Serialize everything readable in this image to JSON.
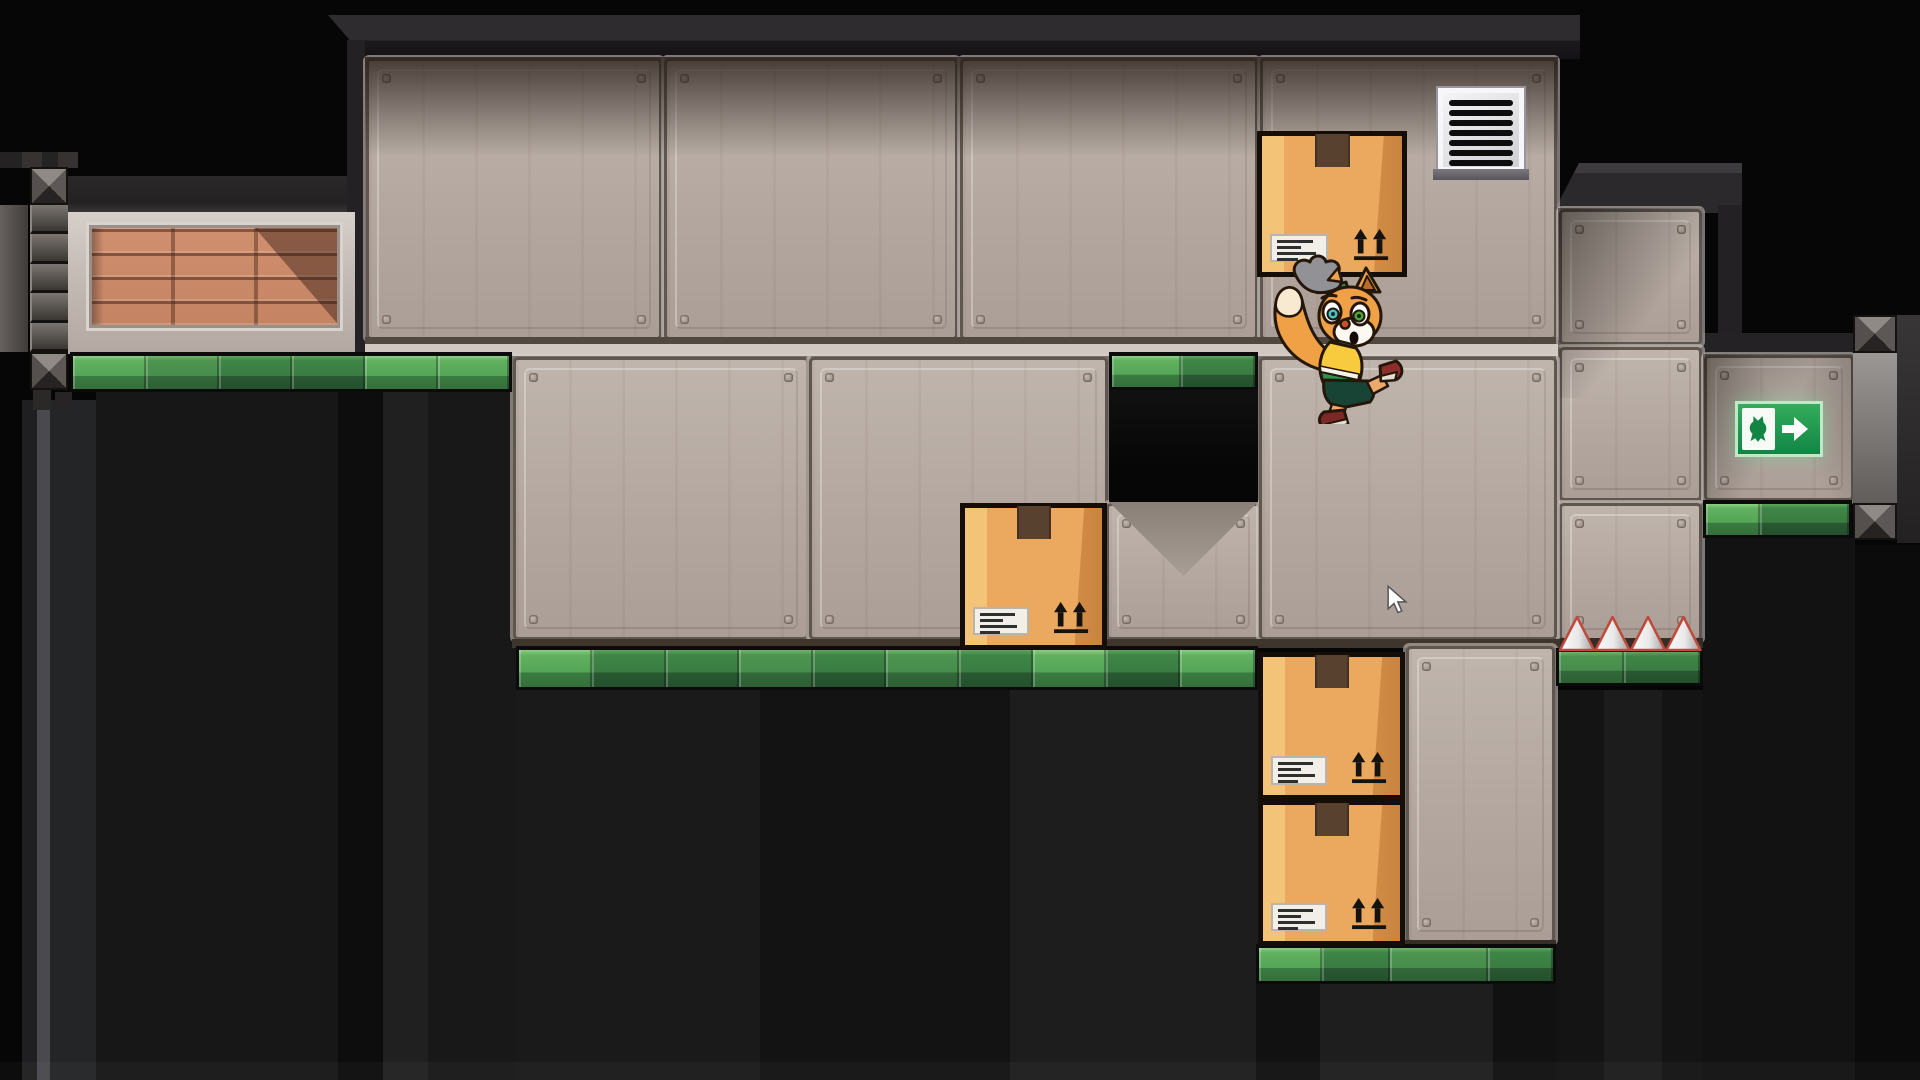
{
  "meta": {
    "app": "2d-puzzle-platformer-level",
    "viewport": {
      "width": 1920,
      "height": 1080
    },
    "scene_summary": "Warehouse-style platformer level: fox character jumps and bumps a cardboard box, three more boxes block passages, green-edged platforms, wall vent, exit sign with fox silhouette and arrow, four floor spikes, riveted metal girders, brick inset wall, dark pits below."
  },
  "palette": {
    "background": "#060606",
    "panel_base": "#b3a79f",
    "panel_groove_dark": "#5f564e",
    "panel_groove_light": "#d7cfc9",
    "green_light": "#61b160",
    "green_mid": "#4c9550",
    "green_dark": "#3f8547",
    "box_face": "#eaa95e",
    "box_shade": "#d18c44",
    "box_highlight": "#f3c377",
    "box_outline": "#150e08",
    "exit_green": "#128544",
    "spike_outline": "#bf4a3c",
    "character_fur": "#f0a145",
    "character_sleeve": "#2f9464",
    "character_vest": "#f8ca3e",
    "character_shorts": "#174434",
    "character_shoe": "#8e2e2c",
    "eye_left_iris": "#49c2c6",
    "eye_right_iris": "#4da53e"
  },
  "entities": {
    "boxes_count": 4,
    "spikes_count": 4,
    "vent_slats": 7,
    "box_marking": "this-side-up arrows + shipping label",
    "exit_sign_glyphs": [
      "fox-silhouette",
      "right-arrow"
    ]
  },
  "items": [
    {
      "kind": "rect",
      "name": "pit-stripe",
      "x": 22,
      "y": 400,
      "w": 15,
      "h": 680,
      "bg": "#1f1f21"
    },
    {
      "kind": "rect",
      "name": "pit-stripe",
      "x": 37,
      "y": 400,
      "w": 13,
      "h": 680,
      "bg": "#4a4a4e"
    },
    {
      "kind": "rect",
      "name": "pit-stripe",
      "x": 50,
      "y": 400,
      "w": 46,
      "h": 680,
      "bg": "#232527"
    },
    {
      "kind": "rect",
      "name": "pit-stripe",
      "x": 96,
      "y": 392,
      "w": 242,
      "h": 688,
      "bg": "#171717"
    },
    {
      "kind": "rect",
      "name": "pit-stripe",
      "x": 338,
      "y": 392,
      "w": 45,
      "h": 688,
      "bg": "#0d0d0d"
    },
    {
      "kind": "rect",
      "name": "pit-stripe",
      "x": 383,
      "y": 392,
      "w": 45,
      "h": 688,
      "bg": "#202020"
    },
    {
      "kind": "rect",
      "name": "pit-stripe",
      "x": 428,
      "y": 392,
      "w": 88,
      "h": 688,
      "bg": "#181818"
    },
    {
      "kind": "rect",
      "name": "pit-stripe",
      "x": 516,
      "y": 690,
      "w": 244,
      "h": 390,
      "bg": "#1a1a1a"
    },
    {
      "kind": "rect",
      "name": "pit-stripe",
      "x": 760,
      "y": 690,
      "w": 250,
      "h": 390,
      "bg": "#131313"
    },
    {
      "kind": "rect",
      "name": "pit-stripe",
      "x": 1010,
      "y": 690,
      "w": 248,
      "h": 390,
      "bg": "#1d1d1d"
    },
    {
      "kind": "rect",
      "name": "pit-stripe",
      "x": 1256,
      "y": 984,
      "w": 64,
      "h": 96,
      "bg": "#111111"
    },
    {
      "kind": "rect",
      "name": "pit-stripe",
      "x": 1320,
      "y": 984,
      "w": 173,
      "h": 96,
      "bg": "#1e1e1e"
    },
    {
      "kind": "rect",
      "name": "pit-stripe",
      "x": 1493,
      "y": 984,
      "w": 63,
      "h": 96,
      "bg": "#111111"
    },
    {
      "kind": "rect",
      "name": "pit-stripe",
      "x": 1556,
      "y": 690,
      "w": 147,
      "h": 390,
      "bg": "#141414"
    },
    {
      "kind": "rect",
      "name": "pit-stripe",
      "x": 1604,
      "y": 690,
      "w": 58,
      "h": 390,
      "bg": "#1c1c1c"
    },
    {
      "kind": "rect",
      "name": "pit-stripe",
      "x": 1703,
      "y": 538,
      "w": 152,
      "h": 542,
      "bg": "#121212"
    },
    {
      "kind": "rect",
      "name": "pit-stripe",
      "x": 1855,
      "y": 545,
      "w": 65,
      "h": 535,
      "bg": "#0b0b0b"
    },
    {
      "kind": "rect",
      "name": "floor-sheen",
      "x": 0,
      "y": 1062,
      "w": 1920,
      "h": 18,
      "bg": "rgba(255,255,255,0.03)"
    },
    {
      "kind": "rect",
      "name": "ceiling-band",
      "x": 328,
      "y": 15,
      "w": 1252,
      "h": 44,
      "bg": "linear-gradient(180deg,#2e2c2f 0%,#2e2c2f 58%,#1b191c 58%,#141216 100%)",
      "clip": "polygon(0px 0px,100% 0px,100% 100%,38px 100%)"
    },
    {
      "kind": "rect",
      "name": "room-left-wall-edge",
      "x": 347,
      "y": 40,
      "w": 18,
      "h": 316,
      "bg": "#232123"
    },
    {
      "kind": "rect",
      "name": "ceiling-band",
      "x": 68,
      "y": 176,
      "w": 279,
      "h": 38,
      "bg": "linear-gradient(180deg,#2a2829 0%,#232122 70%,#3c3a39 100%)"
    },
    {
      "kind": "rect",
      "name": "ceiling-step-cap",
      "x": 1553,
      "y": 163,
      "w": 189,
      "h": 50,
      "bg": "linear-gradient(180deg,#3d3b3e 0%,#3d3b3e 20%,#2b292c 20%)",
      "clip": "polygon(26px 0,100% 0,100% 100%,0 100%)"
    },
    {
      "kind": "rect",
      "name": "ceiling-step-side",
      "x": 1718,
      "y": 205,
      "w": 24,
      "h": 130,
      "bg": "#232123"
    },
    {
      "kind": "rect",
      "name": "alcove-ceiling",
      "x": 1703,
      "y": 333,
      "w": 152,
      "h": 23,
      "bg": "#242224"
    },
    {
      "kind": "panel",
      "name": "wall-panel",
      "x": 369,
      "y": 61,
      "w": 290,
      "h": 276
    },
    {
      "kind": "panel",
      "name": "wall-panel",
      "x": 667,
      "y": 61,
      "w": 288,
      "h": 276
    },
    {
      "kind": "panel",
      "name": "wall-panel",
      "x": 963,
      "y": 61,
      "w": 292,
      "h": 276
    },
    {
      "kind": "panel",
      "name": "wall-panel",
      "x": 1263,
      "y": 61,
      "w": 291,
      "h": 276
    },
    {
      "kind": "rect",
      "name": "floor-seam",
      "x": 365,
      "y": 337,
      "w": 1193,
      "h": 7,
      "bg": "#51483f"
    },
    {
      "kind": "rect",
      "name": "floor-seam",
      "x": 365,
      "y": 344,
      "w": 1193,
      "h": 12,
      "bg": "#d1c8c2"
    },
    {
      "kind": "rect",
      "name": "ceiling-shadow",
      "x": 365,
      "y": 57,
      "w": 1193,
      "h": 100,
      "bg": "linear-gradient(180deg,rgba(38,28,22,0.80),rgba(38,28,22,0))"
    },
    {
      "kind": "panel",
      "name": "wall-panel",
      "x": 1562,
      "y": 212,
      "w": 137,
      "h": 130
    },
    {
      "kind": "panel",
      "name": "wall-panel",
      "x": 1562,
      "y": 350,
      "w": 137,
      "h": 148
    },
    {
      "kind": "panel",
      "name": "wall-panel",
      "x": 1562,
      "y": 506,
      "w": 137,
      "h": 132
    },
    {
      "kind": "rect",
      "name": "wall-bottom-edge",
      "x": 1558,
      "y": 638,
      "w": 145,
      "h": 12,
      "bg": "#352e27"
    },
    {
      "kind": "rect",
      "name": "step-shadow",
      "x": 1558,
      "y": 208,
      "w": 145,
      "h": 190,
      "bg": "linear-gradient(128deg,rgba(15,10,7,0.55),rgba(15,10,7,0) 60%)"
    },
    {
      "kind": "panel",
      "name": "wall-panel",
      "x": 516,
      "y": 360,
      "w": 290,
      "h": 277
    },
    {
      "kind": "panel",
      "name": "wall-panel",
      "x": 812,
      "y": 360,
      "w": 293,
      "h": 277
    },
    {
      "kind": "panel",
      "name": "wall-panel",
      "x": 1109,
      "y": 506,
      "w": 149,
      "h": 131
    },
    {
      "kind": "panel",
      "name": "wall-panel",
      "x": 1262,
      "y": 360,
      "w": 292,
      "h": 277
    },
    {
      "kind": "rect",
      "name": "wall-bottom-edge",
      "x": 512,
      "y": 639,
      "w": 1048,
      "h": 9,
      "bg": "#3e352c"
    },
    {
      "kind": "tri",
      "name": "alcove-shadow-triangle",
      "x": 1109,
      "y": 502,
      "w": 149,
      "h": 74,
      "bg": "linear-gradient(180deg,#8a7f76,#a99e96)",
      "clip": "polygon(0 0,100% 0,50% 100%)"
    },
    {
      "kind": "rect",
      "name": "recessed-alcove",
      "x": 1109,
      "y": 388,
      "w": 149,
      "h": 114,
      "bg": "linear-gradient(180deg,#111111,#060606 70%)"
    },
    {
      "kind": "panel",
      "name": "wall-panel",
      "x": 1409,
      "y": 649,
      "w": 143,
      "h": 291
    },
    {
      "kind": "rect",
      "name": "wall-bottom-edge",
      "x": 1405,
      "y": 940,
      "w": 151,
      "h": 8,
      "bg": "#352d26"
    },
    {
      "kind": "panel",
      "name": "wall-panel",
      "x": 1707,
      "y": 358,
      "w": 144,
      "h": 140
    },
    {
      "kind": "rect",
      "name": "exit-alcove-shadow",
      "x": 1703,
      "y": 354,
      "w": 152,
      "h": 148,
      "bg": "linear-gradient(118deg,rgba(18,12,8,0.50),rgba(18,12,8,0) 50%)"
    },
    {
      "kind": "rect",
      "name": "exit-alcove-shadow",
      "x": 1703,
      "y": 354,
      "w": 152,
      "h": 148,
      "bg": "linear-gradient(242deg,rgba(18,12,8,0.30),rgba(18,12,8,0) 45%)"
    },
    {
      "kind": "rect",
      "name": "brick-frame",
      "x": 68,
      "y": 212,
      "w": 287,
      "h": 142,
      "bg": "linear-gradient(180deg,#d6cfca 0%,#c6bdb7 40%,#b3a8a1 100%)"
    },
    {
      "kind": "bricks",
      "name": "brick-inset",
      "x": 92,
      "y": 228,
      "w": 245,
      "h": 97
    },
    {
      "kind": "tri",
      "name": "brick-shadow",
      "x": 255,
      "y": 228,
      "w": 82,
      "h": 95,
      "bg": "rgba(40,20,12,0.42)",
      "clip": "polygon(0 0,100% 0,100% 100%)"
    },
    {
      "kind": "rect",
      "name": "brick-shadow",
      "x": 92,
      "y": 228,
      "w": 12,
      "h": 97,
      "bg": "linear-gradient(90deg,rgba(0,0,0,0.30),rgba(0,0,0,0))"
    },
    {
      "kind": "rect",
      "name": "girder-top-band",
      "x": 0,
      "y": 152,
      "w": 78,
      "h": 16,
      "bg": "#242222"
    },
    {
      "kind": "rect",
      "name": "girder-top-band",
      "x": 22,
      "y": 152,
      "w": 20,
      "h": 16,
      "bg": "#353231"
    },
    {
      "kind": "rect",
      "name": "girder-top-band",
      "x": 58,
      "y": 152,
      "w": 20,
      "h": 16,
      "bg": "#353231"
    },
    {
      "kind": "xtile",
      "name": "girder-cross-joint",
      "x": 30,
      "y": 167,
      "w": 38,
      "h": 38
    },
    {
      "kind": "rect",
      "name": "girder-bar",
      "x": 0,
      "y": 205,
      "w": 28,
      "h": 147,
      "bg": "linear-gradient(90deg,#66615e,#403c3a)"
    },
    {
      "kind": "segcol",
      "name": "girder-segments",
      "x": 30,
      "y": 205,
      "w": 38,
      "h": 147
    },
    {
      "kind": "xtile",
      "name": "girder-cross-joint",
      "x": 30,
      "y": 352,
      "w": 38,
      "h": 38
    },
    {
      "kind": "rect",
      "name": "girder-foot-block",
      "x": 33,
      "y": 390,
      "w": 18,
      "h": 20,
      "bg": "#2b2928"
    },
    {
      "kind": "rect",
      "name": "girder-foot-block",
      "x": 55,
      "y": 392,
      "w": 17,
      "h": 18,
      "bg": "#262424"
    },
    {
      "kind": "xtile",
      "name": "girder-cross-joint",
      "x": 1853,
      "y": 315,
      "w": 44,
      "h": 38
    },
    {
      "kind": "rect",
      "name": "girder-bar",
      "x": 1853,
      "y": 353,
      "w": 44,
      "h": 150,
      "bg": "linear-gradient(180deg,#9b9795,#615d5b)"
    },
    {
      "kind": "xtile",
      "name": "girder-cross-joint",
      "x": 1853,
      "y": 503,
      "w": 44,
      "h": 37
    },
    {
      "kind": "rect",
      "name": "girder-bar",
      "x": 1897,
      "y": 315,
      "w": 23,
      "h": 228,
      "bg": "linear-gradient(180deg,#383636,#232121)"
    },
    {
      "kind": "strip",
      "name": "green-platform-edge",
      "x": 70,
      "y": 352,
      "w": 442,
      "h": 40,
      "segs": [
        74,
        74,
        74,
        74,
        74,
        72
      ],
      "shades": [
        "light",
        "mid",
        "dark",
        "dark",
        "light",
        "light"
      ]
    },
    {
      "kind": "strip",
      "name": "green-platform-edge",
      "x": 1109,
      "y": 352,
      "w": 149,
      "h": 38,
      "segs": [
        72,
        77
      ],
      "shades": [
        "light",
        "dark"
      ]
    },
    {
      "kind": "strip",
      "name": "green-platform-edge",
      "x": 516,
      "y": 646,
      "w": 742,
      "h": 44,
      "segs": [
        74,
        74,
        74,
        74,
        74,
        74,
        74,
        74,
        74,
        76
      ],
      "shades": [
        "light",
        "dark",
        "dark",
        "mid",
        "dark",
        "mid",
        "dark",
        "light",
        "dark",
        "light"
      ]
    },
    {
      "kind": "strip",
      "name": "green-platform-edge",
      "x": 1703,
      "y": 500,
      "w": 149,
      "h": 38,
      "segs": [
        56,
        93
      ],
      "shades": [
        "light",
        "dark"
      ]
    },
    {
      "kind": "strip",
      "name": "green-platform-edge",
      "x": 1556,
      "y": 648,
      "w": 147,
      "h": 38,
      "segs": [
        68,
        79
      ],
      "shades": [
        "mid",
        "dark"
      ]
    },
    {
      "kind": "strip",
      "name": "green-platform-edge",
      "x": 1256,
      "y": 944,
      "w": 300,
      "h": 40,
      "segs": [
        64,
        70,
        100,
        66
      ],
      "shades": [
        "light",
        "dark",
        "mid",
        "dark"
      ]
    },
    {
      "kind": "spikes",
      "name": "spikes",
      "x": 1558,
      "y": 614,
      "w": 145,
      "h": 38
    },
    {
      "kind": "vent",
      "name": "air-vent",
      "x": 1438,
      "y": 88,
      "w": 86,
      "h": 84
    },
    {
      "kind": "rect",
      "name": "air-vent-lip",
      "x": 1433,
      "y": 169,
      "w": 96,
      "h": 11,
      "bg": "linear-gradient(180deg,#7b797e,#57555a)"
    },
    {
      "kind": "sign",
      "name": "exit-sign",
      "x": 1735,
      "y": 401,
      "w": 88,
      "h": 56
    },
    {
      "kind": "box",
      "name": "cardboard-box",
      "x": 1257,
      "y": 131,
      "w": 150,
      "h": 146
    },
    {
      "kind": "box",
      "name": "cardboard-box",
      "x": 960,
      "y": 503,
      "w": 147,
      "h": 147
    },
    {
      "kind": "box",
      "name": "cardboard-box",
      "x": 1258,
      "y": 652,
      "w": 147,
      "h": 148
    },
    {
      "kind": "box",
      "name": "cardboard-box",
      "x": 1258,
      "y": 800,
      "w": 147,
      "h": 146
    },
    {
      "kind": "char",
      "name": "fox-character",
      "x": 1266,
      "y": 254,
      "w": 140,
      "h": 170
    },
    {
      "kind": "cursor",
      "name": "mouse-cursor",
      "x": 1386,
      "y": 585,
      "w": 22,
      "h": 30
    }
  ]
}
